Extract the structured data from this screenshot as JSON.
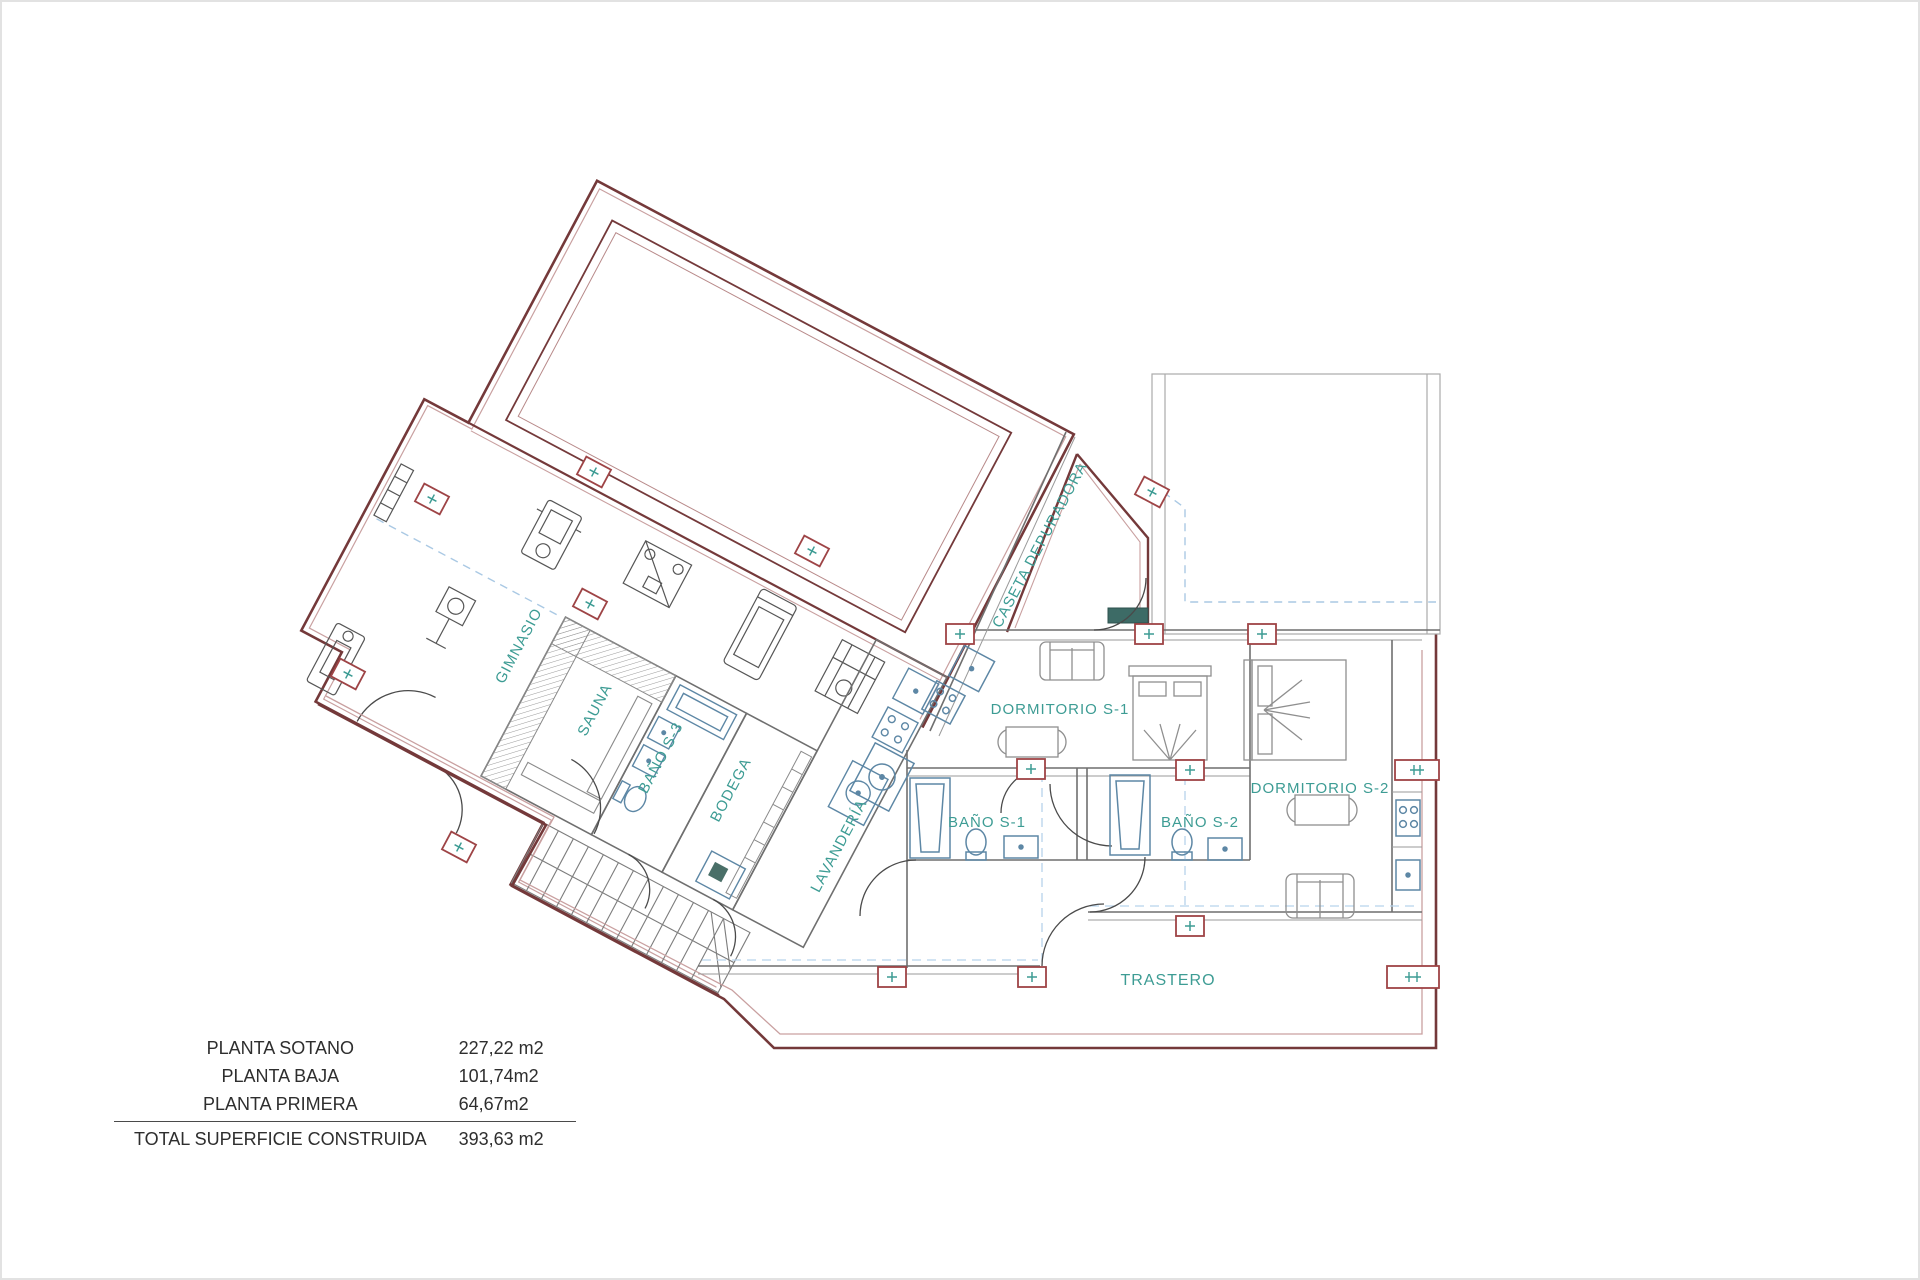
{
  "plan": {
    "rooms": [
      {
        "label": "GIMNASIO"
      },
      {
        "label": "SAUNA"
      },
      {
        "label": "BAÑO S-3"
      },
      {
        "label": "BODEGA"
      },
      {
        "label": "LAVANDERÍA"
      },
      {
        "label": "CASETA DEPURADORA"
      },
      {
        "label": "DORMITORIO S-1"
      },
      {
        "label": "BAÑO S-1"
      },
      {
        "label": "BAÑO S-2"
      },
      {
        "label": "DORMITORIO S-2"
      },
      {
        "label": "TRASTERO"
      }
    ],
    "colors": {
      "wall_dark_red": "#74393a",
      "wall_light_red": "#c9a0a0",
      "wall_gray": "#6f6f6f",
      "label_teal": "#3d9c94",
      "dashed_blue": "#aac9e4",
      "fixture_blue": "#5d87a5",
      "furniture_gray": "#8f8f8f",
      "marker_red": "#9e4446"
    }
  },
  "area_table": {
    "rows": [
      {
        "label": "PLANTA SOTANO",
        "value": "227,22 m2"
      },
      {
        "label": "PLANTA BAJA",
        "value": "101,74m2"
      },
      {
        "label": "PLANTA PRIMERA",
        "value": "64,67m2"
      }
    ],
    "total": {
      "label": "TOTAL SUPERFICIE CONSTRUIDA",
      "value": "393,63 m2"
    }
  }
}
